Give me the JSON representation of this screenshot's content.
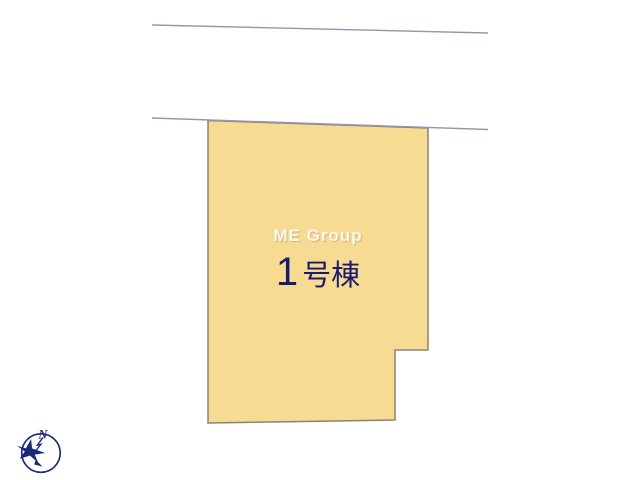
{
  "plan": {
    "lot": {
      "watermark": "ME Group",
      "label_number": "1",
      "label_suffix": "号棟"
    },
    "compass": {
      "north_label": "N"
    }
  },
  "colors": {
    "background": "#ffffff",
    "lot_fill": "#f8db93",
    "lot_outline": "#8c8274",
    "road_line": "#9595b1",
    "label_text": "#1b1b6b",
    "watermark_text": "#ffffff",
    "compass": "#1b2a78"
  }
}
